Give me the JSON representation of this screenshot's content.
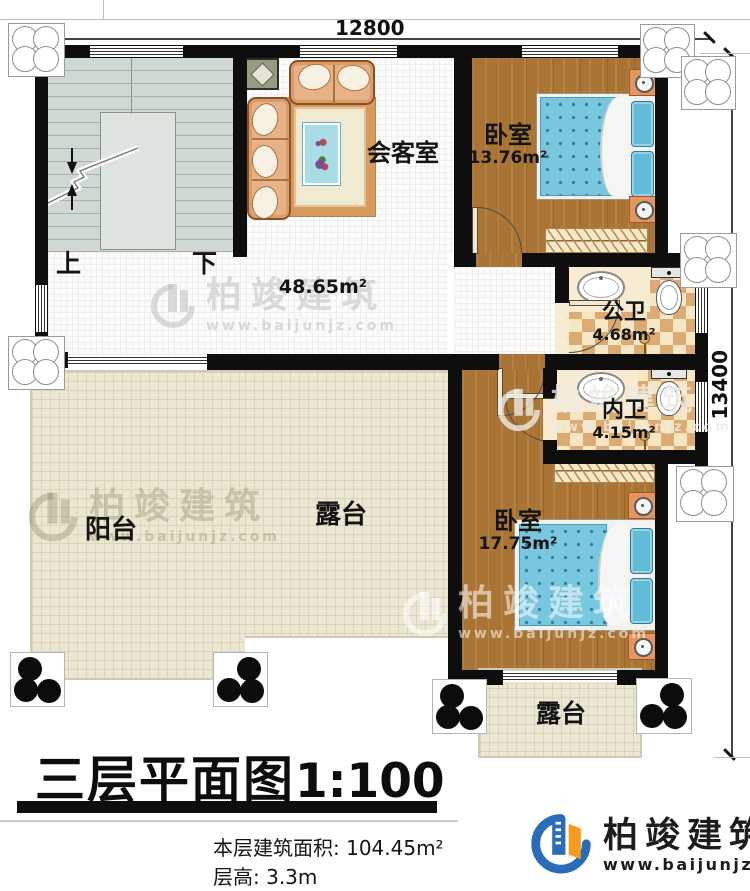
{
  "dimensions": {
    "top_label": "12800",
    "right_label": "13400"
  },
  "stairs": {
    "up_label": "上",
    "down_label": "下"
  },
  "rooms": {
    "reception": {
      "name": "会客室"
    },
    "hall": {
      "area": "48.65m²"
    },
    "bedroom1": {
      "name": "卧室",
      "area": "13.76m²"
    },
    "public_bath": {
      "name": "公卫",
      "area": "4.68m²"
    },
    "inner_bath": {
      "name": "内卫",
      "area": "4.15m²"
    },
    "bedroom2": {
      "name": "卧室",
      "area": "17.75m²"
    },
    "balcony": {
      "name": "阳台"
    },
    "main_terrace": {
      "name": "露台"
    },
    "small_terrace": {
      "name": "露台"
    }
  },
  "title_block": {
    "title": "三层平面图",
    "scale": "1:100",
    "floor_area_label": "本层建筑面积: 104.45m²",
    "floor_height_label": "层高: 3.3m"
  },
  "brand": {
    "name": "柏竣建筑",
    "url": "www.baijunjz.com"
  },
  "colors": {
    "wall": "#0e0e0e",
    "wood_floor": "#aa7434",
    "tile_dark": "#dcab73",
    "tile_light": "#f6e7c4",
    "terrace": "#ebe7d3",
    "mattress_blue": "#79c6df",
    "stair_grey": "#cfd8d2",
    "logo_blue": "#2b6cb8",
    "logo_orange": "#f59a23"
  }
}
